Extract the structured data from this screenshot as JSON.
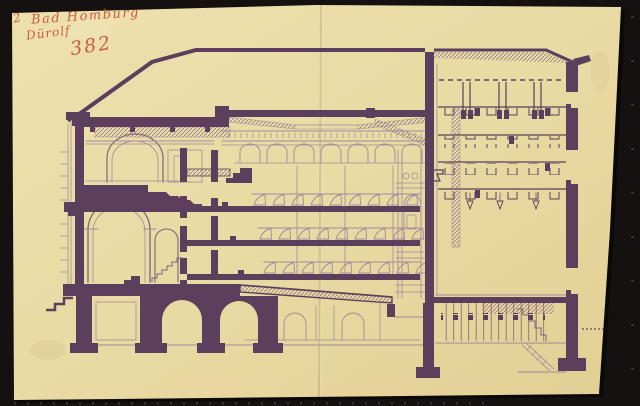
{
  "annotations": {
    "corner_mark": "2",
    "title_line": "Bad Homburg",
    "author_line": "Dürolf",
    "sheet_number": "382"
  },
  "palette": {
    "scan_background": "#141110",
    "paper": "#e9d9a2",
    "ink_dark": "#5d3e5d",
    "ink_medium": "#82617d",
    "ink_light": "#a5879d",
    "hatch": "#8d6a86",
    "red_ink": "#c44b38"
  }
}
